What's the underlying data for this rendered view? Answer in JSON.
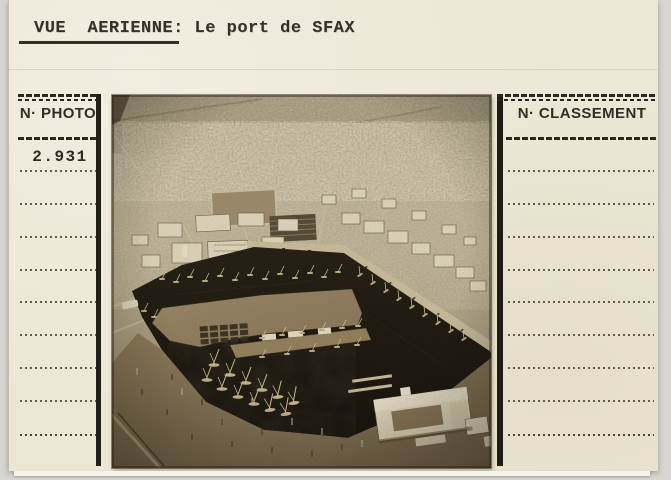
{
  "page": {
    "background_color": "#d6d5d1"
  },
  "card": {
    "background_color": "#ece7d5",
    "ink_color": "#2f2a22",
    "title": {
      "underlined": "VUE  AERIENNE:",
      "rest": " Le port de SFAX"
    },
    "photo_column": {
      "header": "N· PHOTO",
      "number": "2.931"
    },
    "classement_column": {
      "header": "N· CLASSEMENT"
    },
    "photo": {
      "alt": "Vue aérienne du port de Sfax : ville en arrière-plan, bassin sombre rempli de voiliers, terre-plein central, jetée et bâtiments blancs du port",
      "tone": "sepia"
    }
  }
}
